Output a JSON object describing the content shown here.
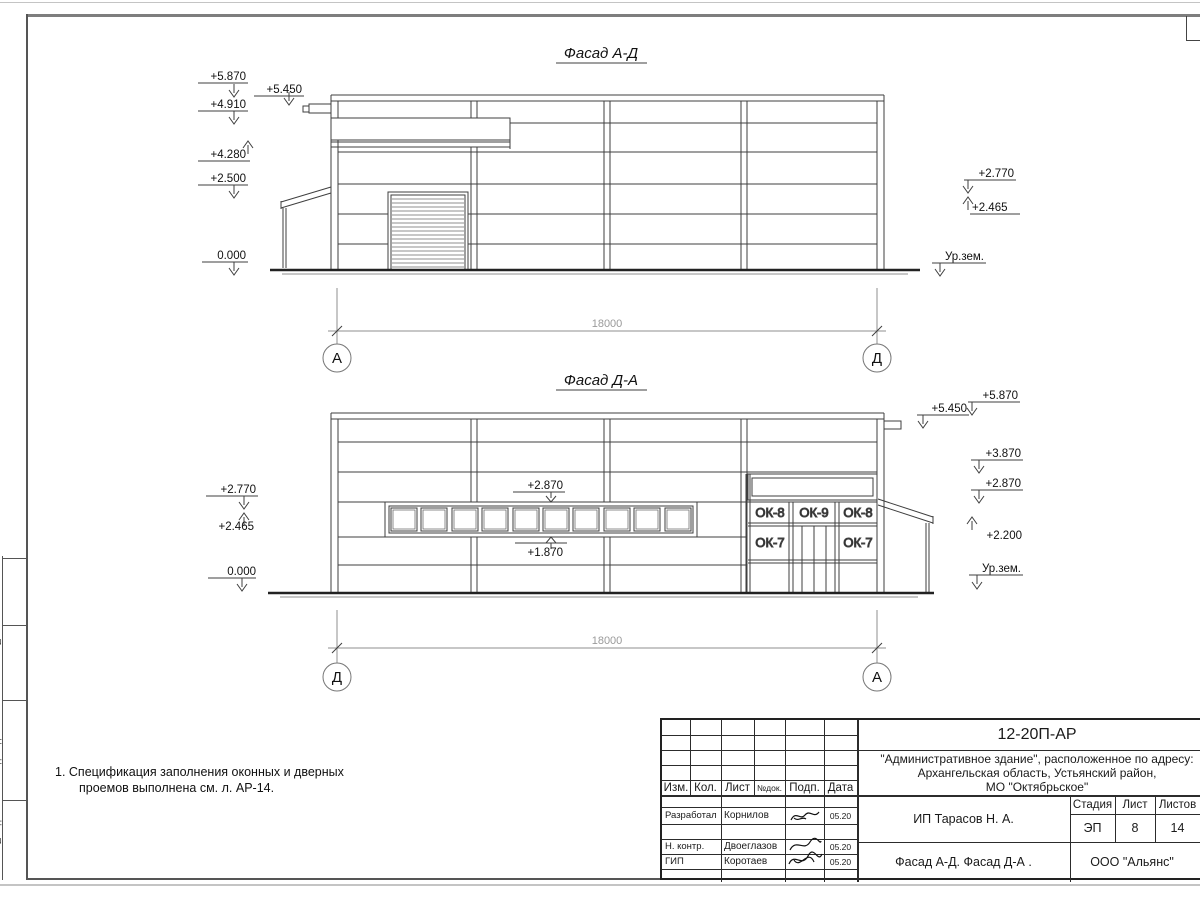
{
  "facade_ad": {
    "title": "Фасад А-Д",
    "marks": {
      "m5870": "+5.870",
      "m5450": "+5.450",
      "m4910": "+4.910",
      "m4280": "+4.280",
      "m2500": "+2.500",
      "m0000": "0.000",
      "m2770": "+2.770",
      "m2465": "+2.465",
      "ground": "Ур.зем."
    },
    "dim": "18000",
    "axis_left": "А",
    "axis_right": "Д"
  },
  "facade_da": {
    "title": "Фасад Д-А",
    "marks": {
      "m2770": "+2.770",
      "m2465": "+2.465",
      "m0000": "0.000",
      "w2870": "+2.870",
      "w1870": "+1.870",
      "m5870": "+5.870",
      "m5450": "+5.450",
      "m3870": "+3.870",
      "r2870": "+2.870",
      "m2200": "+2.200",
      "ground": "Ур.зем."
    },
    "windows": {
      "ok8": "ОК-8",
      "ok9": "ОК-9",
      "ok7": "ОК-7"
    },
    "dim": "18000",
    "axis_left": "Д",
    "axis_right": "А"
  },
  "notes": {
    "line1": "1. Спецификация заполнения оконных и дверных",
    "line2": "проемов выполнена см. л. АР-14."
  },
  "title_block": {
    "doc_number": "12-20П-АР",
    "project_line1": "\"Административное здание\", расположенное по адресу:",
    "project_line2": "Архангельская область, Устьянский район,",
    "project_line3": "МО \"Октябрьское\"",
    "header": {
      "izm": "Изм.",
      "kol": "Кол.",
      "list": "Лист",
      "ndok": "№док.",
      "podp": "Подп.",
      "data": "Дата"
    },
    "rows": [
      {
        "role": "Разработал",
        "name": "Корнилов",
        "date": "05.20"
      },
      {
        "role": "Н. контр.",
        "name": "Двоеглазов",
        "date": "05.20"
      },
      {
        "role": "ГИП",
        "name": "Коротаев",
        "date": "05.20"
      }
    ],
    "client": "ИП Тарасов Н. А.",
    "stage_header": {
      "stage": "Стадия",
      "sheet": "Лист",
      "sheets": "Листов"
    },
    "stage_values": {
      "stage": "ЭП",
      "sheet": "8",
      "sheets": "14"
    },
    "sheet_title": "Фасад А-Д. Фасад Д-А .",
    "company": "ООО \"Альянс\""
  },
  "margin": {
    "box1": "Взам. инв. №",
    "box2": "Подп. и дата",
    "box3": "Инв. № подл."
  }
}
